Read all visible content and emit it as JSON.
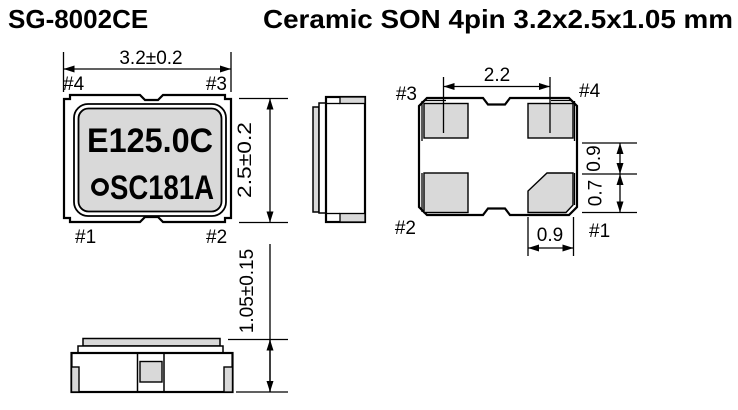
{
  "header": {
    "part_number": "SG-8002CE",
    "package_title": "Ceramic SON 4pin 3.2x2.5x1.05 mm"
  },
  "colors": {
    "pad_gray": "#d9d9d9",
    "line_black": "#000000",
    "background": "#ffffff"
  },
  "top_view": {
    "marking": {
      "line1": "E125.0C",
      "line2": "SC181A"
    },
    "logo_icon": "circle-quality-mark",
    "pins": {
      "top_left": "#4",
      "top_right": "#3",
      "bottom_left": "#1",
      "bottom_right": "#2"
    },
    "dims": {
      "width": "3.2±0.2",
      "height": "2.5±0.2"
    }
  },
  "bottom_view": {
    "pins": {
      "top_left": "#3",
      "top_right": "#4",
      "bottom_left": "#2",
      "bottom_right": "#1"
    },
    "dims": {
      "pad_pitch": "2.2",
      "edge_upper": "0.9",
      "edge_lower": "0.7",
      "pad_width": "0.9"
    }
  },
  "front_view": {
    "dims": {
      "height": "1.05±0.15"
    }
  }
}
